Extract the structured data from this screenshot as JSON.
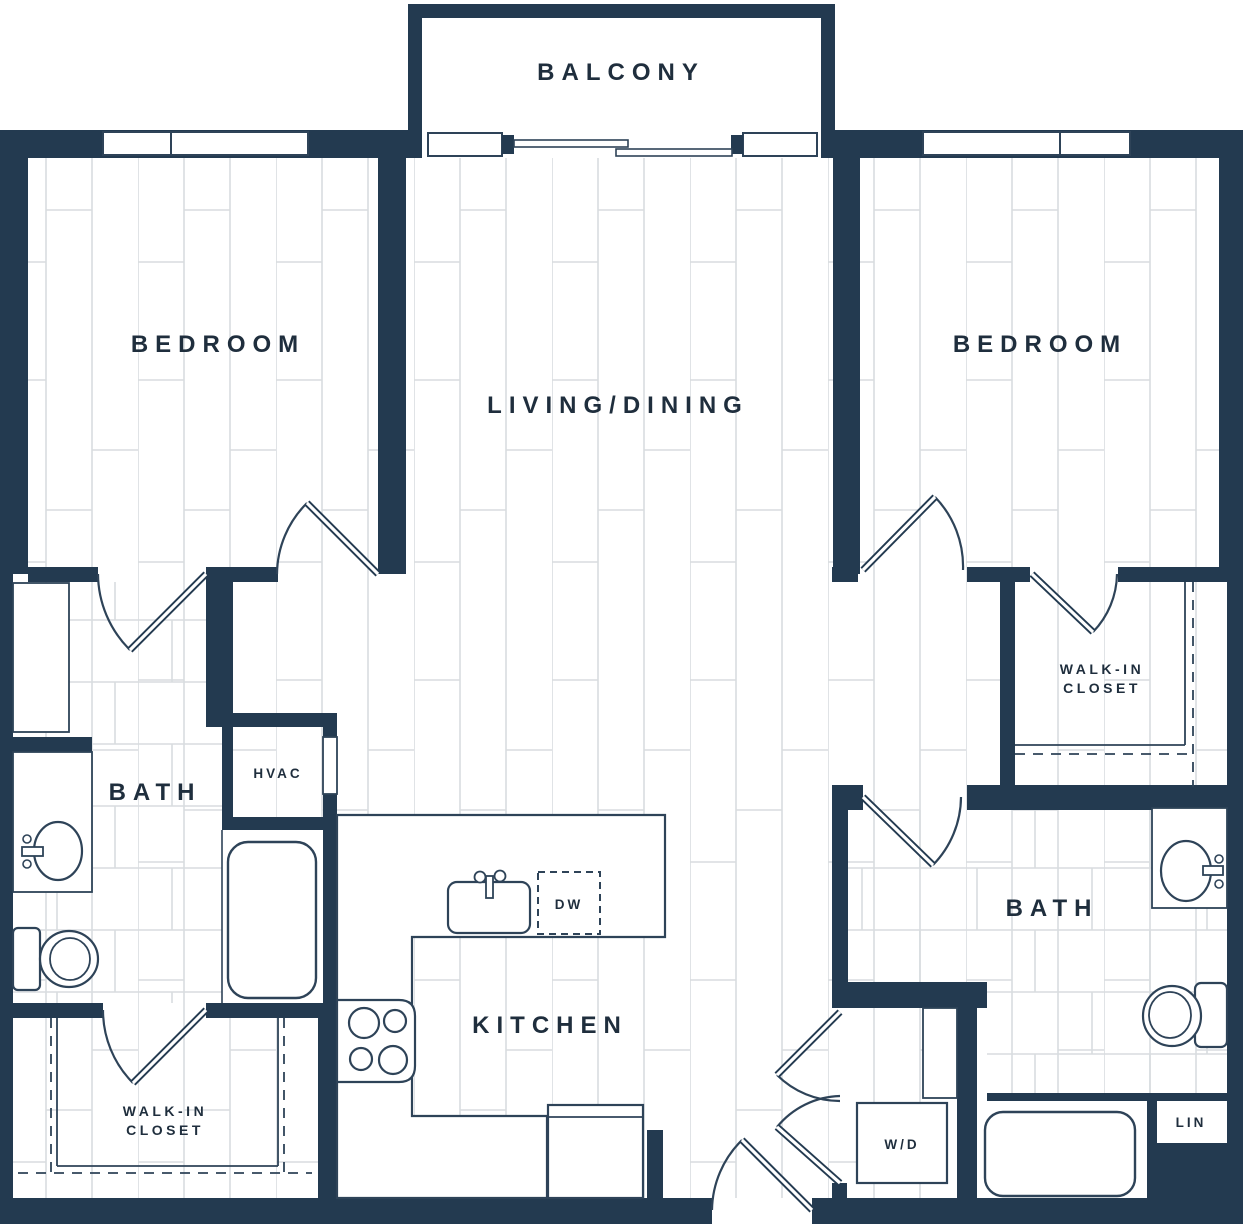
{
  "colors": {
    "wall": "#233a50",
    "line": "#2e4358",
    "floor_line": "#d8dcdf",
    "text": "#1f2e3d",
    "background": "#ffffff"
  },
  "labels": {
    "balcony": "BALCONY",
    "bedroom_left": "BEDROOM",
    "bedroom_right": "BEDROOM",
    "living_dining": "LIVING/DINING",
    "bath_left": "BATH",
    "bath_right": "BATH",
    "kitchen": "KITCHEN",
    "hvac": "HVAC",
    "dishwasher": "DW",
    "washer_dryer": "W/D",
    "linen": "LIN",
    "walk_in_left_line1": "WALK-IN",
    "walk_in_left_line2": "CLOSET",
    "walk_in_right_line1": "WALK-IN",
    "walk_in_right_line2": "CLOSET"
  }
}
